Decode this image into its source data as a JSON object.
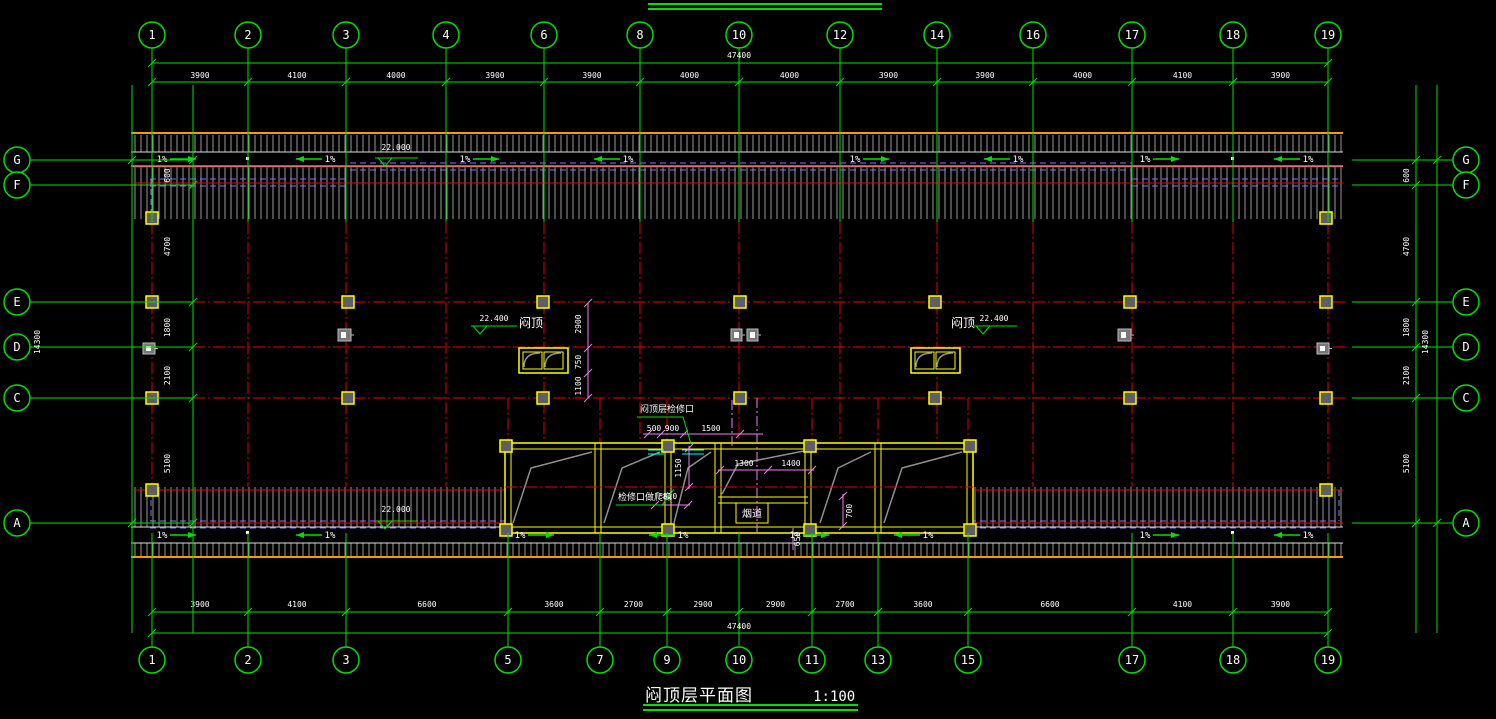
{
  "drawing": {
    "title": "闷顶层平面图",
    "scale": "1:100",
    "overall_width_dim": "47400",
    "overall_height_dim": "14300"
  },
  "axes": {
    "top": [
      {
        "label": "1",
        "x": 152
      },
      {
        "label": "2",
        "x": 248
      },
      {
        "label": "3",
        "x": 346
      },
      {
        "label": "4",
        "x": 446
      },
      {
        "label": "6",
        "x": 544
      },
      {
        "label": "8",
        "x": 640
      },
      {
        "label": "10",
        "x": 739
      },
      {
        "label": "12",
        "x": 840
      },
      {
        "label": "14",
        "x": 937
      },
      {
        "label": "16",
        "x": 1033
      },
      {
        "label": "17",
        "x": 1132
      },
      {
        "label": "18",
        "x": 1233
      },
      {
        "label": "19",
        "x": 1328
      }
    ],
    "bottom": [
      {
        "label": "1",
        "x": 152
      },
      {
        "label": "2",
        "x": 248
      },
      {
        "label": "3",
        "x": 346
      },
      {
        "label": "5",
        "x": 508
      },
      {
        "label": "7",
        "x": 600
      },
      {
        "label": "9",
        "x": 667
      },
      {
        "label": "10",
        "x": 739
      },
      {
        "label": "11",
        "x": 812
      },
      {
        "label": "13",
        "x": 878
      },
      {
        "label": "15",
        "x": 968
      },
      {
        "label": "17",
        "x": 1132
      },
      {
        "label": "18",
        "x": 1233
      },
      {
        "label": "19",
        "x": 1328
      }
    ],
    "left": [
      {
        "label": "G",
        "y": 160
      },
      {
        "label": "F",
        "y": 185
      },
      {
        "label": "E",
        "y": 302
      },
      {
        "label": "D",
        "y": 347
      },
      {
        "label": "C",
        "y": 398
      },
      {
        "label": "A",
        "y": 523
      }
    ],
    "right": [
      {
        "label": "G",
        "y": 160
      },
      {
        "label": "F",
        "y": 185
      },
      {
        "label": "E",
        "y": 302
      },
      {
        "label": "D",
        "y": 347
      },
      {
        "label": "C",
        "y": 398
      },
      {
        "label": "A",
        "y": 523
      }
    ]
  },
  "dimensions": {
    "top": [
      "3900",
      "4100",
      "4000",
      "3900",
      "3900",
      "4000",
      "4000",
      "3900",
      "3900",
      "4000",
      "4100",
      "3900"
    ],
    "bottom": [
      "3900",
      "4100",
      "6600",
      "3600",
      "2700",
      "2900",
      "2900",
      "2700",
      "3600",
      "6600",
      "4100",
      "3900"
    ],
    "left": [
      "600",
      "4700",
      "1800",
      "2100",
      "5100"
    ],
    "right": [
      "600",
      "4700",
      "1800",
      "2100",
      "5100"
    ]
  },
  "annotations": {
    "slope_label": "1%",
    "slope_top": [
      {
        "x": 162,
        "d": 1
      },
      {
        "x": 330,
        "d": -1
      },
      {
        "x": 465,
        "d": 1
      },
      {
        "x": 628,
        "d": -1
      },
      {
        "x": 855,
        "d": 1
      },
      {
        "x": 1018,
        "d": -1
      },
      {
        "x": 1145,
        "d": 1
      },
      {
        "x": 1308,
        "d": -1
      }
    ],
    "slope_bottom": [
      {
        "x": 162,
        "d": 1
      },
      {
        "x": 330,
        "d": -1
      },
      {
        "x": 520,
        "d": 1
      },
      {
        "x": 683,
        "d": -1
      },
      {
        "x": 795,
        "d": 1
      },
      {
        "x": 928,
        "d": -1
      },
      {
        "x": 1145,
        "d": 1
      },
      {
        "x": 1308,
        "d": -1
      }
    ],
    "elevations": [
      {
        "value": "22.000",
        "x": 396,
        "y": 150,
        "line": [
          375,
          158,
          418,
          158
        ],
        "apex": [
          385,
          158
        ]
      },
      {
        "value": "22.000",
        "x": 396,
        "y": 512,
        "line": [
          375,
          521,
          418,
          521
        ],
        "apex": [
          385,
          521
        ]
      },
      {
        "value": "22.400",
        "x": 494,
        "y": 321,
        "line": [
          471,
          326,
          517,
          326
        ],
        "apex": [
          480,
          326
        ]
      },
      {
        "value": "22.400",
        "x": 994,
        "y": 321,
        "line": [
          974,
          326,
          1017,
          326
        ],
        "apex": [
          983,
          326
        ]
      }
    ],
    "attic_label": "闷顶",
    "attic_positions": [
      {
        "x": 531,
        "y": 327
      },
      {
        "x": 963,
        "y": 327
      }
    ],
    "duct_label": "烟道",
    "duct_box": {
      "x": 736,
      "y": 503,
      "w": 32,
      "h": 20
    },
    "leaders": [
      {
        "text": "闷顶层检修口",
        "tx": 640,
        "ty": 412,
        "path": "637,417 683,417 691,444"
      },
      {
        "text": "检修口做爬梯",
        "tx": 618,
        "ty": 500,
        "path": "616,505 662,505 674,489"
      }
    ],
    "detail_dims": [
      {
        "text": "500",
        "x": 654,
        "y": 431
      },
      {
        "text": "900",
        "x": 672,
        "y": 431
      },
      {
        "text": "1500",
        "x": 711,
        "y": 431
      },
      {
        "text": "1150",
        "x": 681,
        "y": 468,
        "vertical": true
      },
      {
        "text": "820",
        "x": 670,
        "y": 499
      },
      {
        "text": "1300",
        "x": 744,
        "y": 466
      },
      {
        "text": "1400",
        "x": 791,
        "y": 466
      },
      {
        "text": "700",
        "x": 852,
        "y": 511,
        "vertical": true
      },
      {
        "text": "650",
        "x": 800,
        "y": 539,
        "vertical": true
      },
      {
        "text": "2900",
        "x": 581,
        "y": 324,
        "vertical": true
      },
      {
        "text": "750",
        "x": 581,
        "y": 362,
        "vertical": true
      },
      {
        "text": "1100",
        "x": 581,
        "y": 386,
        "vertical": true
      }
    ]
  },
  "colors": {
    "background": "#000000",
    "grid_green": "#00e000",
    "grid_red": "#e80000",
    "wall_yellow": "#ffff00",
    "dim_magenta": "#ee82ee",
    "hidden_blue": "#7878ff",
    "band_orange": "#ff9900",
    "hatch_gray": "#9a9a9a",
    "strip_white": "#dedede",
    "diag_gray": "#8f8f8f",
    "cyan": "#00ffff",
    "text_white": "#ffffff",
    "column_fill": "#5f5f5f"
  }
}
